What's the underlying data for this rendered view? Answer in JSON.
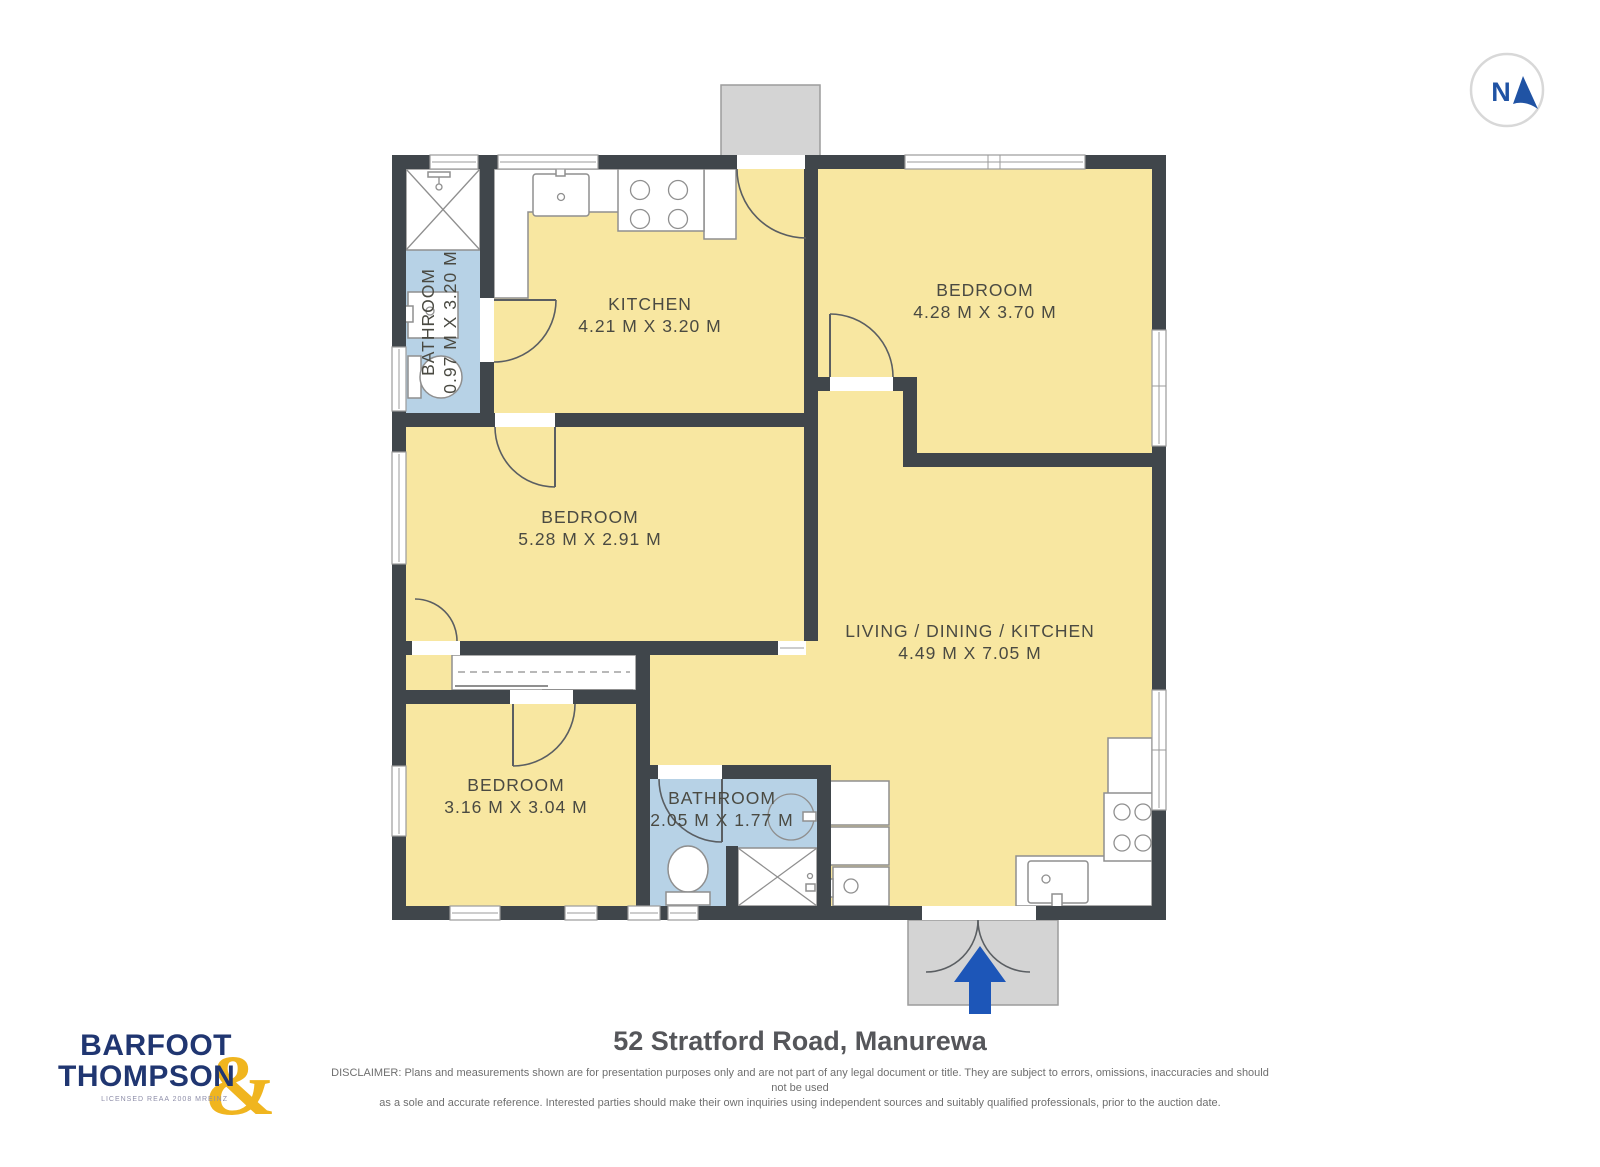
{
  "compass": {
    "label": "N"
  },
  "rooms": [
    {
      "name": "KITCHEN",
      "dims": "4.21 M X 3.20 M"
    },
    {
      "name": "BEDROOM",
      "dims": "4.28 M X 3.70 M"
    },
    {
      "name": "BEDROOM",
      "dims": "5.28 M X 2.91 M"
    },
    {
      "name": "LIVING / DINING / KITCHEN",
      "dims": "4.49 M X 7.05 M"
    },
    {
      "name": "BEDROOM",
      "dims": "3.16 M X 3.04 M"
    },
    {
      "name": "BATHROOM",
      "dims": "2.05 M X 1.77 M"
    },
    {
      "name": "BATHROOM",
      "dims": "0.97 M X 3.20 M"
    }
  ],
  "logo": {
    "line1": "BARFOOT",
    "line2": "THOMPSON",
    "ampersand": "&",
    "tagline": "LICENSED REAA 2008 MREINZ"
  },
  "footer": {
    "address": "52 Stratford Road, Manurewa",
    "disclaimer_line1": "DISCLAIMER: Plans and measurements shown are for presentation purposes only and are not part of any legal document or title. They are subject to errors, omissions, inaccuracies and should not be used",
    "disclaimer_line2": "as a sole and accurate reference. Interested parties should make their own inquiries using independent sources and suitably qualified professionals, prior to the auction date."
  },
  "colors": {
    "room_fill": "#f8e7a1",
    "bathroom_fill": "#b7d2e6",
    "wall": "#40464b",
    "porch": "#d4d4d4",
    "entry_arrow": "#1d56b8",
    "logo_blue": "#203671",
    "logo_gold": "#f0b51f",
    "compass_blue": "#2053a4",
    "label_text": "#4a4a42"
  }
}
